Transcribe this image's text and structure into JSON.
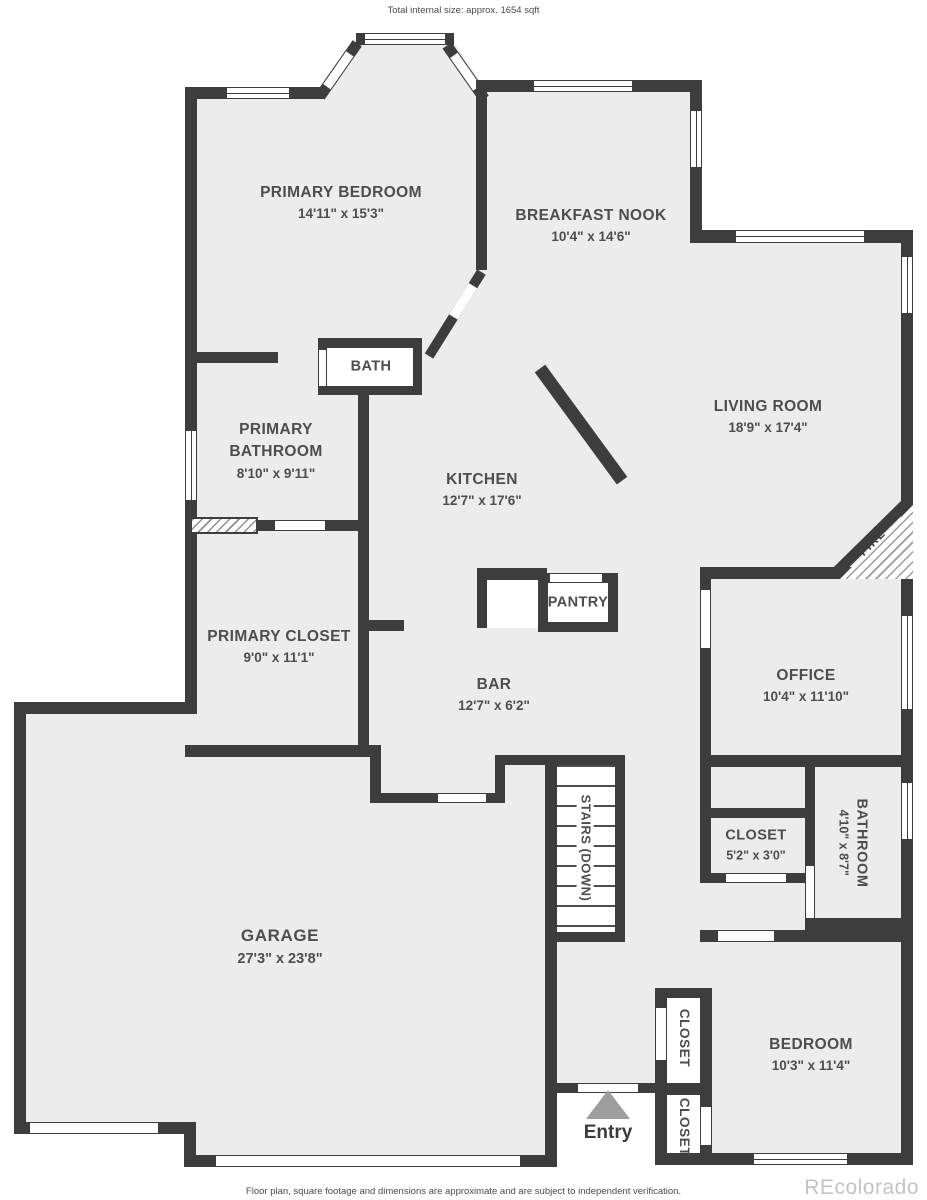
{
  "meta": {
    "size_note": "Total internal size: approx. 1654 sqft",
    "disclaimer": "Floor plan, square footage and dimensions are approximate and are subject to independent verification.",
    "watermark": "REcolorado"
  },
  "colors": {
    "wall": "#3d3d3d",
    "floor": "#ececec",
    "entry_arrow": "#9e9e9e",
    "label_text": "#4d4d4d",
    "watermark_text": "#c3c3c3"
  },
  "rooms": {
    "primary_bedroom": {
      "name": "PRIMARY BEDROOM",
      "dims": "14'11\" x 15'3\""
    },
    "breakfast_nook": {
      "name": "BREAKFAST NOOK",
      "dims": "10'4\" x 14'6\""
    },
    "bath": {
      "name": "BATH"
    },
    "primary_bathroom": {
      "line1": "PRIMARY",
      "line2": "BATHROOM",
      "dims": "8'10\" x 9'11\""
    },
    "kitchen": {
      "name": "KITCHEN",
      "dims": "12'7\" x 17'6\""
    },
    "living_room": {
      "name": "LIVING ROOM",
      "dims": "18'9\" x 17'4\""
    },
    "pantry": {
      "name": "PANTRY"
    },
    "primary_closet": {
      "name": "PRIMARY CLOSET",
      "dims": "9'0\" x 11'1\""
    },
    "bar": {
      "name": "BAR",
      "dims": "12'7\" x 6'2\""
    },
    "office": {
      "name": "OFFICE",
      "dims": "10'4\" x 11'10\""
    },
    "hall_closet": {
      "name": "CLOSET",
      "dims": "5'2\" x 3'0\""
    },
    "second_bathroom": {
      "name": "BATHROOM",
      "dims": "4'10\" x 8'7\""
    },
    "stairs": {
      "name": "STAIRS (DOWN)"
    },
    "garage": {
      "name": "GARAGE",
      "dims": "27'3\" x 23'8\""
    },
    "bedroom": {
      "name": "BEDROOM",
      "dims": "10'3\" x 11'4\""
    },
    "entry_closet_upper": {
      "name": "CLOSET"
    },
    "entry_closet_lower": {
      "name": "CLOSET"
    },
    "entry": {
      "name": "Entry"
    },
    "fireplace": {
      "name": "FIRE"
    }
  }
}
